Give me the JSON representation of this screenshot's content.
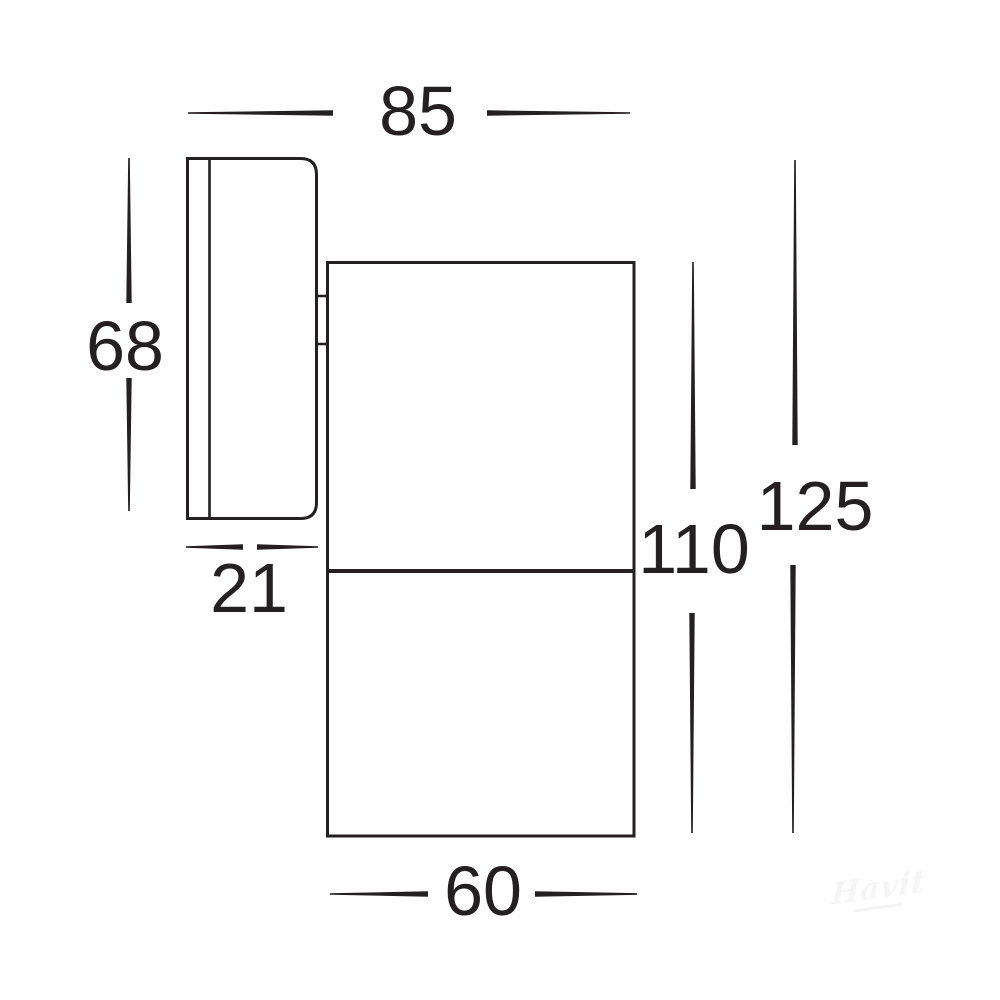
{
  "colors": {
    "ink": "#241f21",
    "background": "#ffffff",
    "watermark": "#f5f5f5"
  },
  "dimensions": {
    "overall_depth": {
      "value": "85"
    },
    "plate_height": {
      "value": "68"
    },
    "plate_depth": {
      "value": "21"
    },
    "body_height": {
      "value": "110"
    },
    "overall_height": {
      "value": "125"
    },
    "body_diameter": {
      "value": "60"
    }
  },
  "watermark": {
    "text": "Havit"
  }
}
